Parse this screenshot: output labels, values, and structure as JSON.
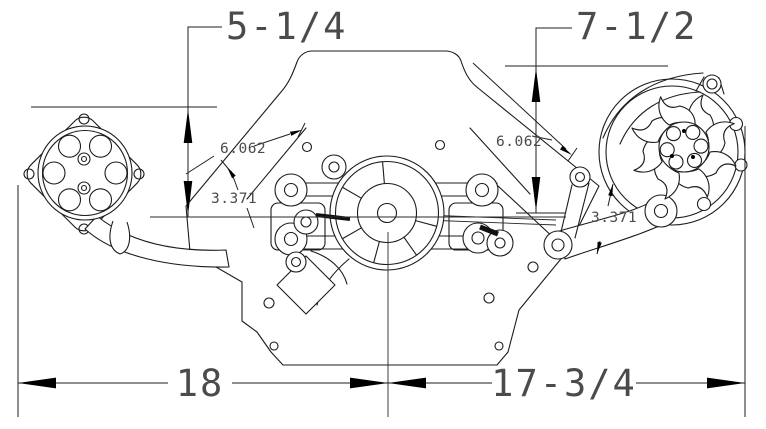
{
  "dimensions": {
    "top_left": "5-1/4",
    "top_right": "7-1/2",
    "left_face": "6.062",
    "left_bracket": "3.371",
    "right_face": "6.062",
    "right_bracket": "3.371",
    "bottom_left": "18",
    "bottom_right": "17-3/4"
  }
}
